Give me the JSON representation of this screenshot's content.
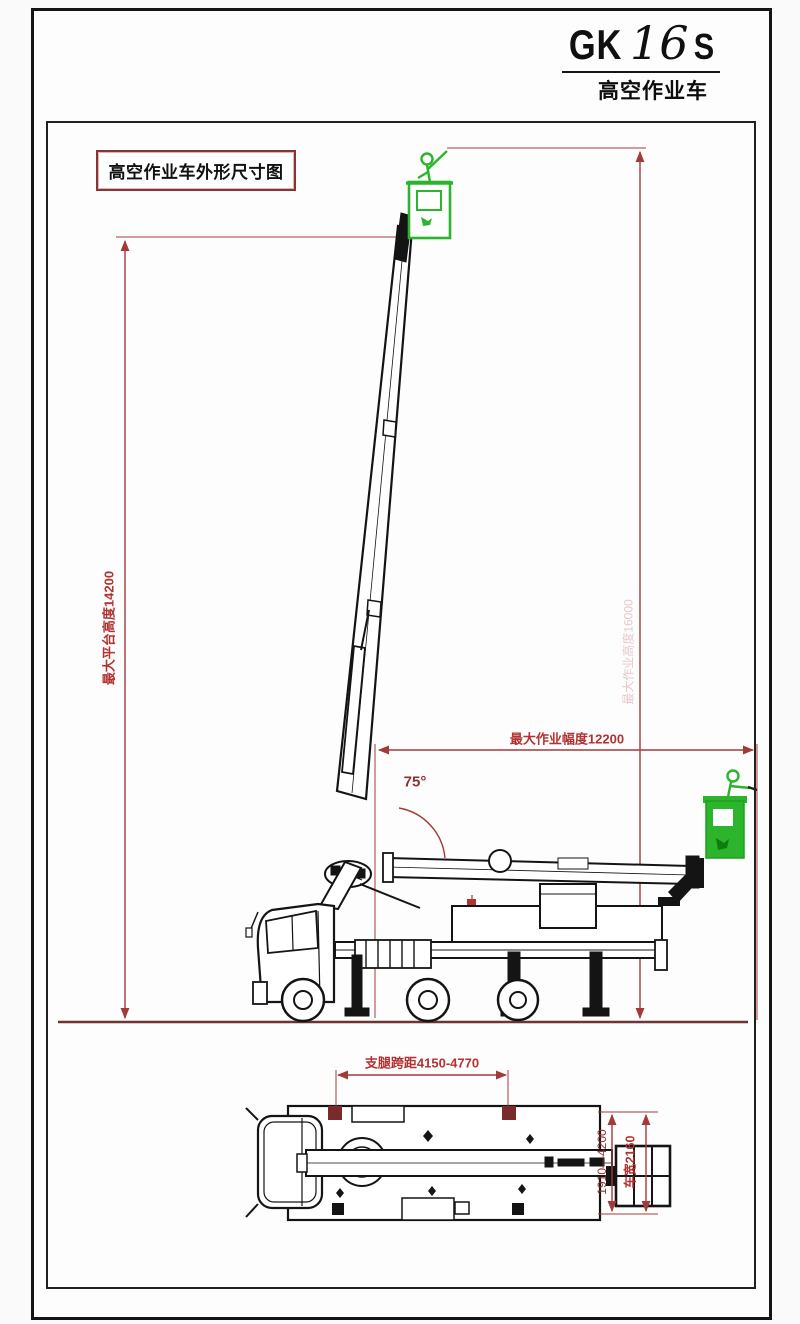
{
  "title_block": {
    "model_prefix": "GK",
    "model_number": "16",
    "model_suffix": "S",
    "subtitle": "高空作业车"
  },
  "drawing_label": "高空作业车外形尺寸图",
  "side_view": {
    "platform_height_label": "最大平台高度14200",
    "working_height_label": "最大作业高度16000",
    "working_radius_label": "最大作业幅度12200",
    "boom_angle_label": "75°"
  },
  "plan_view": {
    "outrigger_span_label": "支腿跨距4150-4770",
    "outrigger_extension_label": "1910—4200",
    "vehicle_width_label": "车宽2160"
  },
  "colors": {
    "dimension_red": "#a33a3a",
    "annotation_red": "#b23232",
    "ground_brown": "#6e3434",
    "basket_green": "#2cb52c",
    "basket_green_dark": "#0d7d0d",
    "outline_black": "#141414",
    "frame_black": "#202020",
    "label_box_border": "#8b3434"
  }
}
